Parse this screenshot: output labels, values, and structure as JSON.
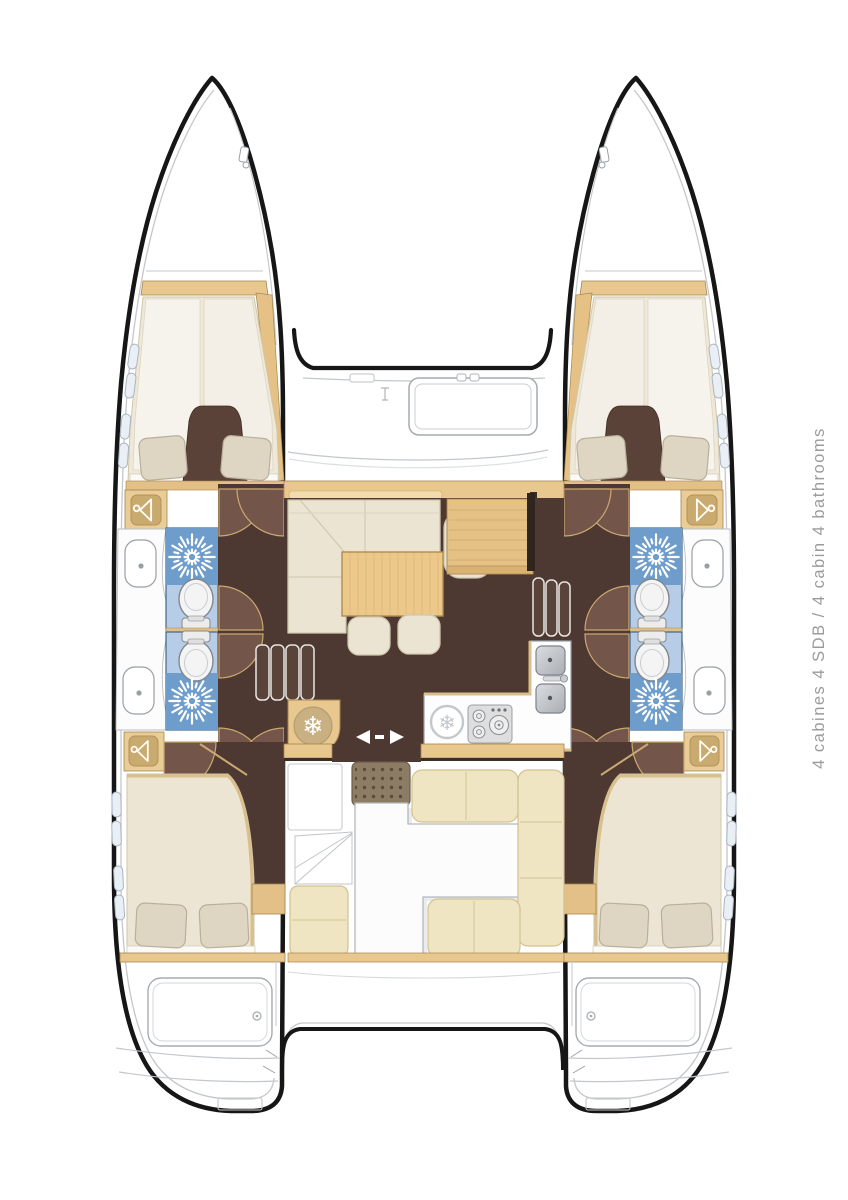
{
  "side_label": {
    "full": "4 cabines 4 SDB / 4 cabin 4 bathrooms",
    "fr": "4 cabines 4 SDB",
    "en": "4 cabin 4 bathrooms",
    "color": "#9b9b9b"
  },
  "icons": {
    "snowflake_glyph": "❄",
    "shower": "starburst-icon",
    "fridge": "snowflake-icon",
    "wardrobe": "hanger-icon",
    "cabin_door": "quarter-arc-swing",
    "saloon_door": "left-right-arrows"
  },
  "palette": {
    "outline": "#161616",
    "wood_tan": "#e9c88f",
    "wood_tan_dark": "#e6c185",
    "wood_edge": "#a5854f",
    "floor_brown": "#4d3932",
    "door_swing_brown": "#735549",
    "divider_brown": "#5a4238",
    "shower_blue": "#6f9dcb",
    "toilet_zone_blue": "#b7cde7",
    "cushion_cream": "#ece4d2",
    "bed_cream": "#ece5d3",
    "pillow_beige": "#ded6c2",
    "cockpit_cushion": "#f0e5c2",
    "counter_white": "#fdfdfd",
    "line_gray": "#c3c7cb",
    "label_gray": "#9b9b9b"
  }
}
